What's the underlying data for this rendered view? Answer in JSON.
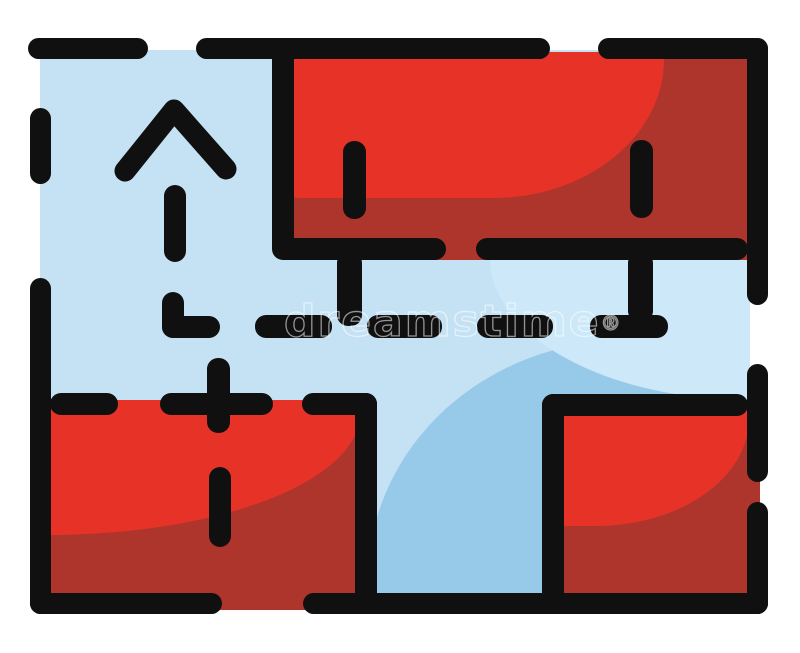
{
  "illustration": {
    "title": "Floor plan red and blue house interior icon",
    "icon": "floor-plan-icon",
    "arrow_icon": "up-arrow-icon",
    "route_icon": "dashed-route-path",
    "watermark": {
      "text": "dreamstime",
      "mark": "®"
    },
    "colors": {
      "paper": "#ffffff",
      "ink": "#101010",
      "red_bright": "#e73327",
      "red_dark": "#ad352c",
      "blue_light": "#c5e2f5",
      "blue_medium": "#97c9e9",
      "blue_highlight": "#cde8f8"
    }
  }
}
